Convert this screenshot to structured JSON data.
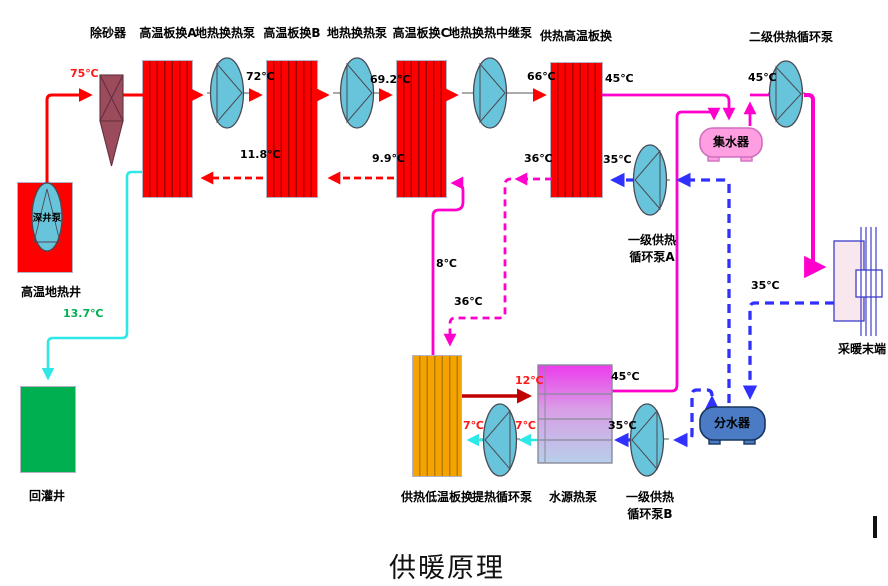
{
  "title": "供暖原理",
  "colors": {
    "hot_red": "#ff0000",
    "supply_magenta": "#ff00cc",
    "return_blue": "#3030ff",
    "reinject_cyan": "#2ee8e8",
    "dark_red": "#c00000",
    "green_label": "#00b050",
    "pump_fill": "#68c4da",
    "collector_fill": "#ff9ee0",
    "distributor_fill": "#4a7bc4"
  },
  "top_row": {
    "sand_remover": "除砂器",
    "hx_a": "高温板换A",
    "pump_geo_1": "地热换热泵",
    "hx_b": "高温板换B",
    "pump_geo_2": "地热换热泵",
    "hx_c": "高温板换C",
    "pump_relay": "地热换热中继泵",
    "hx_supply_high": "供热高温板换",
    "pump_secondary": "二级供热循环泵"
  },
  "left": {
    "deep_well_pump": "深井泵",
    "geo_well": "高温地热井",
    "reinjection_well": "回灌井"
  },
  "middle": {
    "collector": "集水器",
    "pump_primary_a_line1": "一级供热",
    "pump_primary_a_line2": "循环泵A",
    "hx_supply_low": "供热低温板换",
    "pump_extract": "提热循环泵",
    "wshp": "水源热泵",
    "pump_primary_b_line1": "一级供热",
    "pump_primary_b_line2": "循环泵B",
    "distributor": "分水器",
    "terminal": "采暖末端"
  },
  "temps": {
    "t75": "75℃",
    "t72": "72℃",
    "t69_2": "69.2℃",
    "t66": "66℃",
    "t45_hx": "45℃",
    "t45_pump": "45℃",
    "t11_8": "11.8℃",
    "t9_9": "9.9℃",
    "t36_up": "36℃",
    "t35_hx": "35℃",
    "t13_7": "13.7℃",
    "t8": "8℃",
    "t36_low": "36℃",
    "t12": "12℃",
    "t45_wshp": "45℃",
    "t7_a": "7℃",
    "t7_b": "7℃",
    "t35_wshp": "35℃",
    "t35_term": "35℃"
  }
}
